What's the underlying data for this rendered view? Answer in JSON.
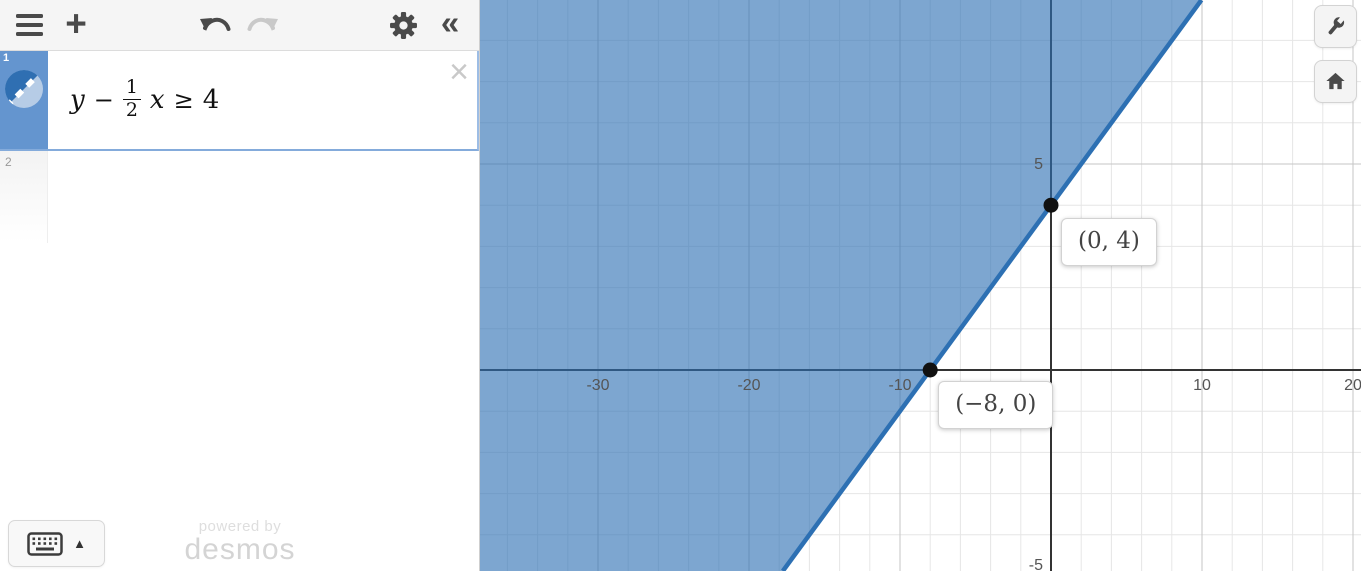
{
  "toolbar": {
    "icons": {
      "plus": "+",
      "collapse": "«"
    }
  },
  "expressions": {
    "close_glyph": "×",
    "rows": [
      {
        "index": "1",
        "tokens": {
          "lhs": "y",
          "minus": "−",
          "frac_num": "1",
          "frac_den": "2",
          "var": "x",
          "relation": "≥",
          "rhs": "4"
        }
      },
      {
        "index": "2"
      }
    ]
  },
  "keyboard": {
    "caret": "▲"
  },
  "watermark": {
    "line1": "powered by",
    "line2": "desmos"
  },
  "graph": {
    "size": [
      881,
      571
    ],
    "viewport": {
      "origin_px": [
        571,
        370
      ],
      "px_per_unit_x": 15.1,
      "px_per_unit_y": 41.2,
      "minor_step_x": 2,
      "minor_step_y": 1,
      "major_step_x": 10,
      "major_step_y": 5
    },
    "axis": {
      "x_ticks": [
        {
          "v": -30,
          "label": "-30"
        },
        {
          "v": -20,
          "label": "-20"
        },
        {
          "v": -10,
          "label": "-10"
        },
        {
          "v": 10,
          "label": "10"
        },
        {
          "v": 20,
          "label": "20"
        }
      ],
      "y_ticks": [
        {
          "v": 5,
          "label": "5"
        },
        {
          "v": -5,
          "label": "-5"
        }
      ]
    },
    "line": {
      "slope": 0.5,
      "intercept": 4,
      "color": "#2d70b3",
      "width": 4.5
    },
    "fill": {
      "color": "rgba(45,112,179,0.62)"
    },
    "points": [
      {
        "x": -8,
        "y": 0,
        "label": "(−8, 0)",
        "label_offset": [
          8,
          11
        ]
      },
      {
        "x": 0,
        "y": 4,
        "label": "(0, 4)",
        "label_offset": [
          10,
          13
        ]
      }
    ],
    "colors": {
      "minor_grid": "#e6e6e6",
      "major_grid": "#c6c6c6",
      "axis": "#333333",
      "tick_text": "#555555",
      "point": "#111111"
    }
  }
}
